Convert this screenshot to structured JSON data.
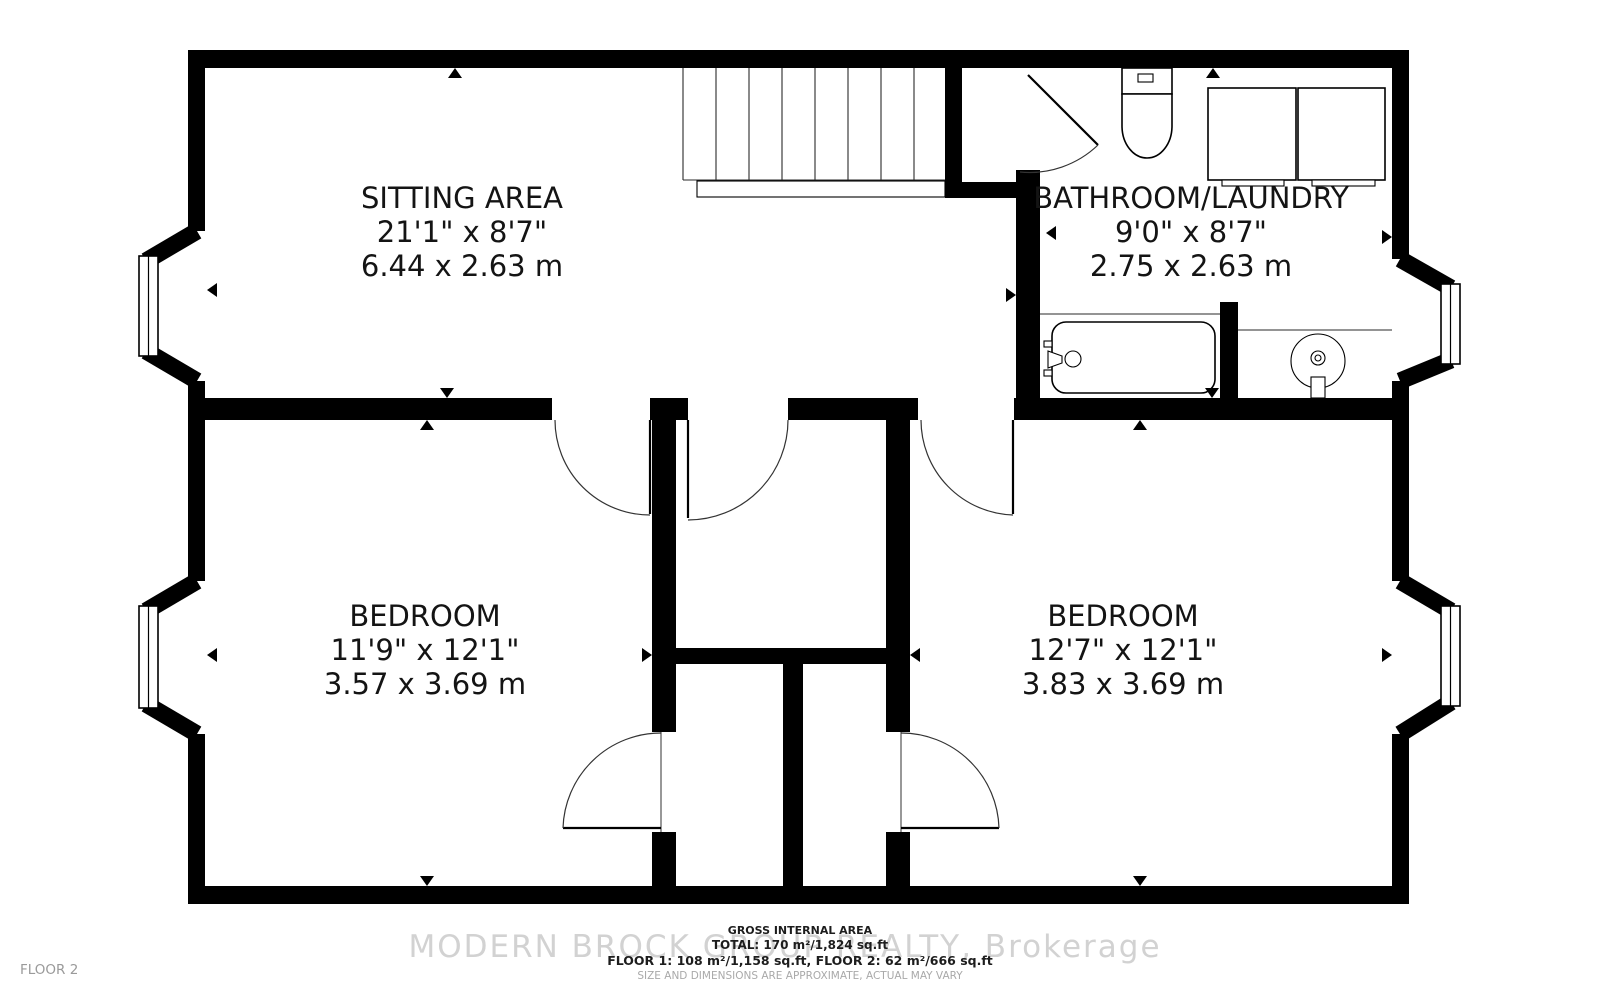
{
  "floor_label": "FLOOR 2",
  "watermark": "MODERN BROCK GROUP REALTY, Brokerage",
  "footer": {
    "line1": "GROSS INTERNAL AREA",
    "line2": "TOTAL: 170 m²/1,824 sq.ft",
    "line3": "FLOOR 1: 108 m²/1,158 sq.ft, FLOOR 2: 62 m²/666 sq.ft",
    "line4": "SIZE AND DIMENSIONS ARE APPROXIMATE, ACTUAL MAY VARY"
  },
  "rooms": {
    "sitting": {
      "name": "SITTING AREA",
      "imperial": "21'1\" x 8'7\"",
      "metric": "6.44 x 2.63 m"
    },
    "bathroom": {
      "name": "BATHROOM/LAUNDRY",
      "imperial": "9'0\" x 8'7\"",
      "metric": "2.75 x 2.63 m"
    },
    "bedroom_left": {
      "name": "BEDROOM",
      "imperial": "11'9\" x 12'1\"",
      "metric": "3.57 x 3.69 m"
    },
    "bedroom_right": {
      "name": "BEDROOM",
      "imperial": "12'7\" x 12'1\"",
      "metric": "3.83 x 3.69 m"
    }
  },
  "colors": {
    "wall": "#000000",
    "watermark": "#d2d2d2",
    "muted_text": "#a9a9a9",
    "floor_label": "#9a9a9a"
  }
}
